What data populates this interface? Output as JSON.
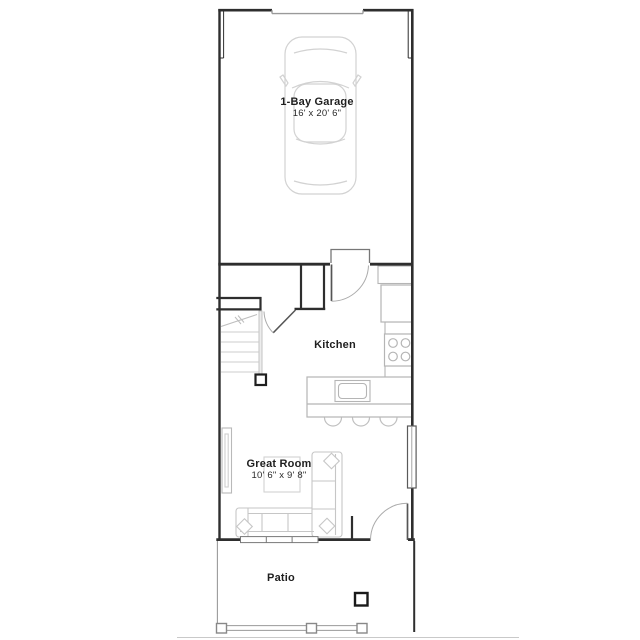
{
  "floor_plan": {
    "type": "townhome-first-floor",
    "rooms": [
      {
        "name": "1-Bay Garage",
        "dimensions": "16' x 20' 6\""
      },
      {
        "name": "Kitchen",
        "dimensions": ""
      },
      {
        "name": "Great Room",
        "dimensions": "10' 6\" x 9' 8\""
      },
      {
        "name": "Patio",
        "dimensions": ""
      }
    ],
    "colors": {
      "wall": "#2e2e2e",
      "door": "#555555",
      "door_swing": "#aaaaaa",
      "fixture": "#b5b5b5",
      "furniture": "#c6c6c6",
      "stairs": "#c9c9c9",
      "background": "#ffffff"
    }
  }
}
